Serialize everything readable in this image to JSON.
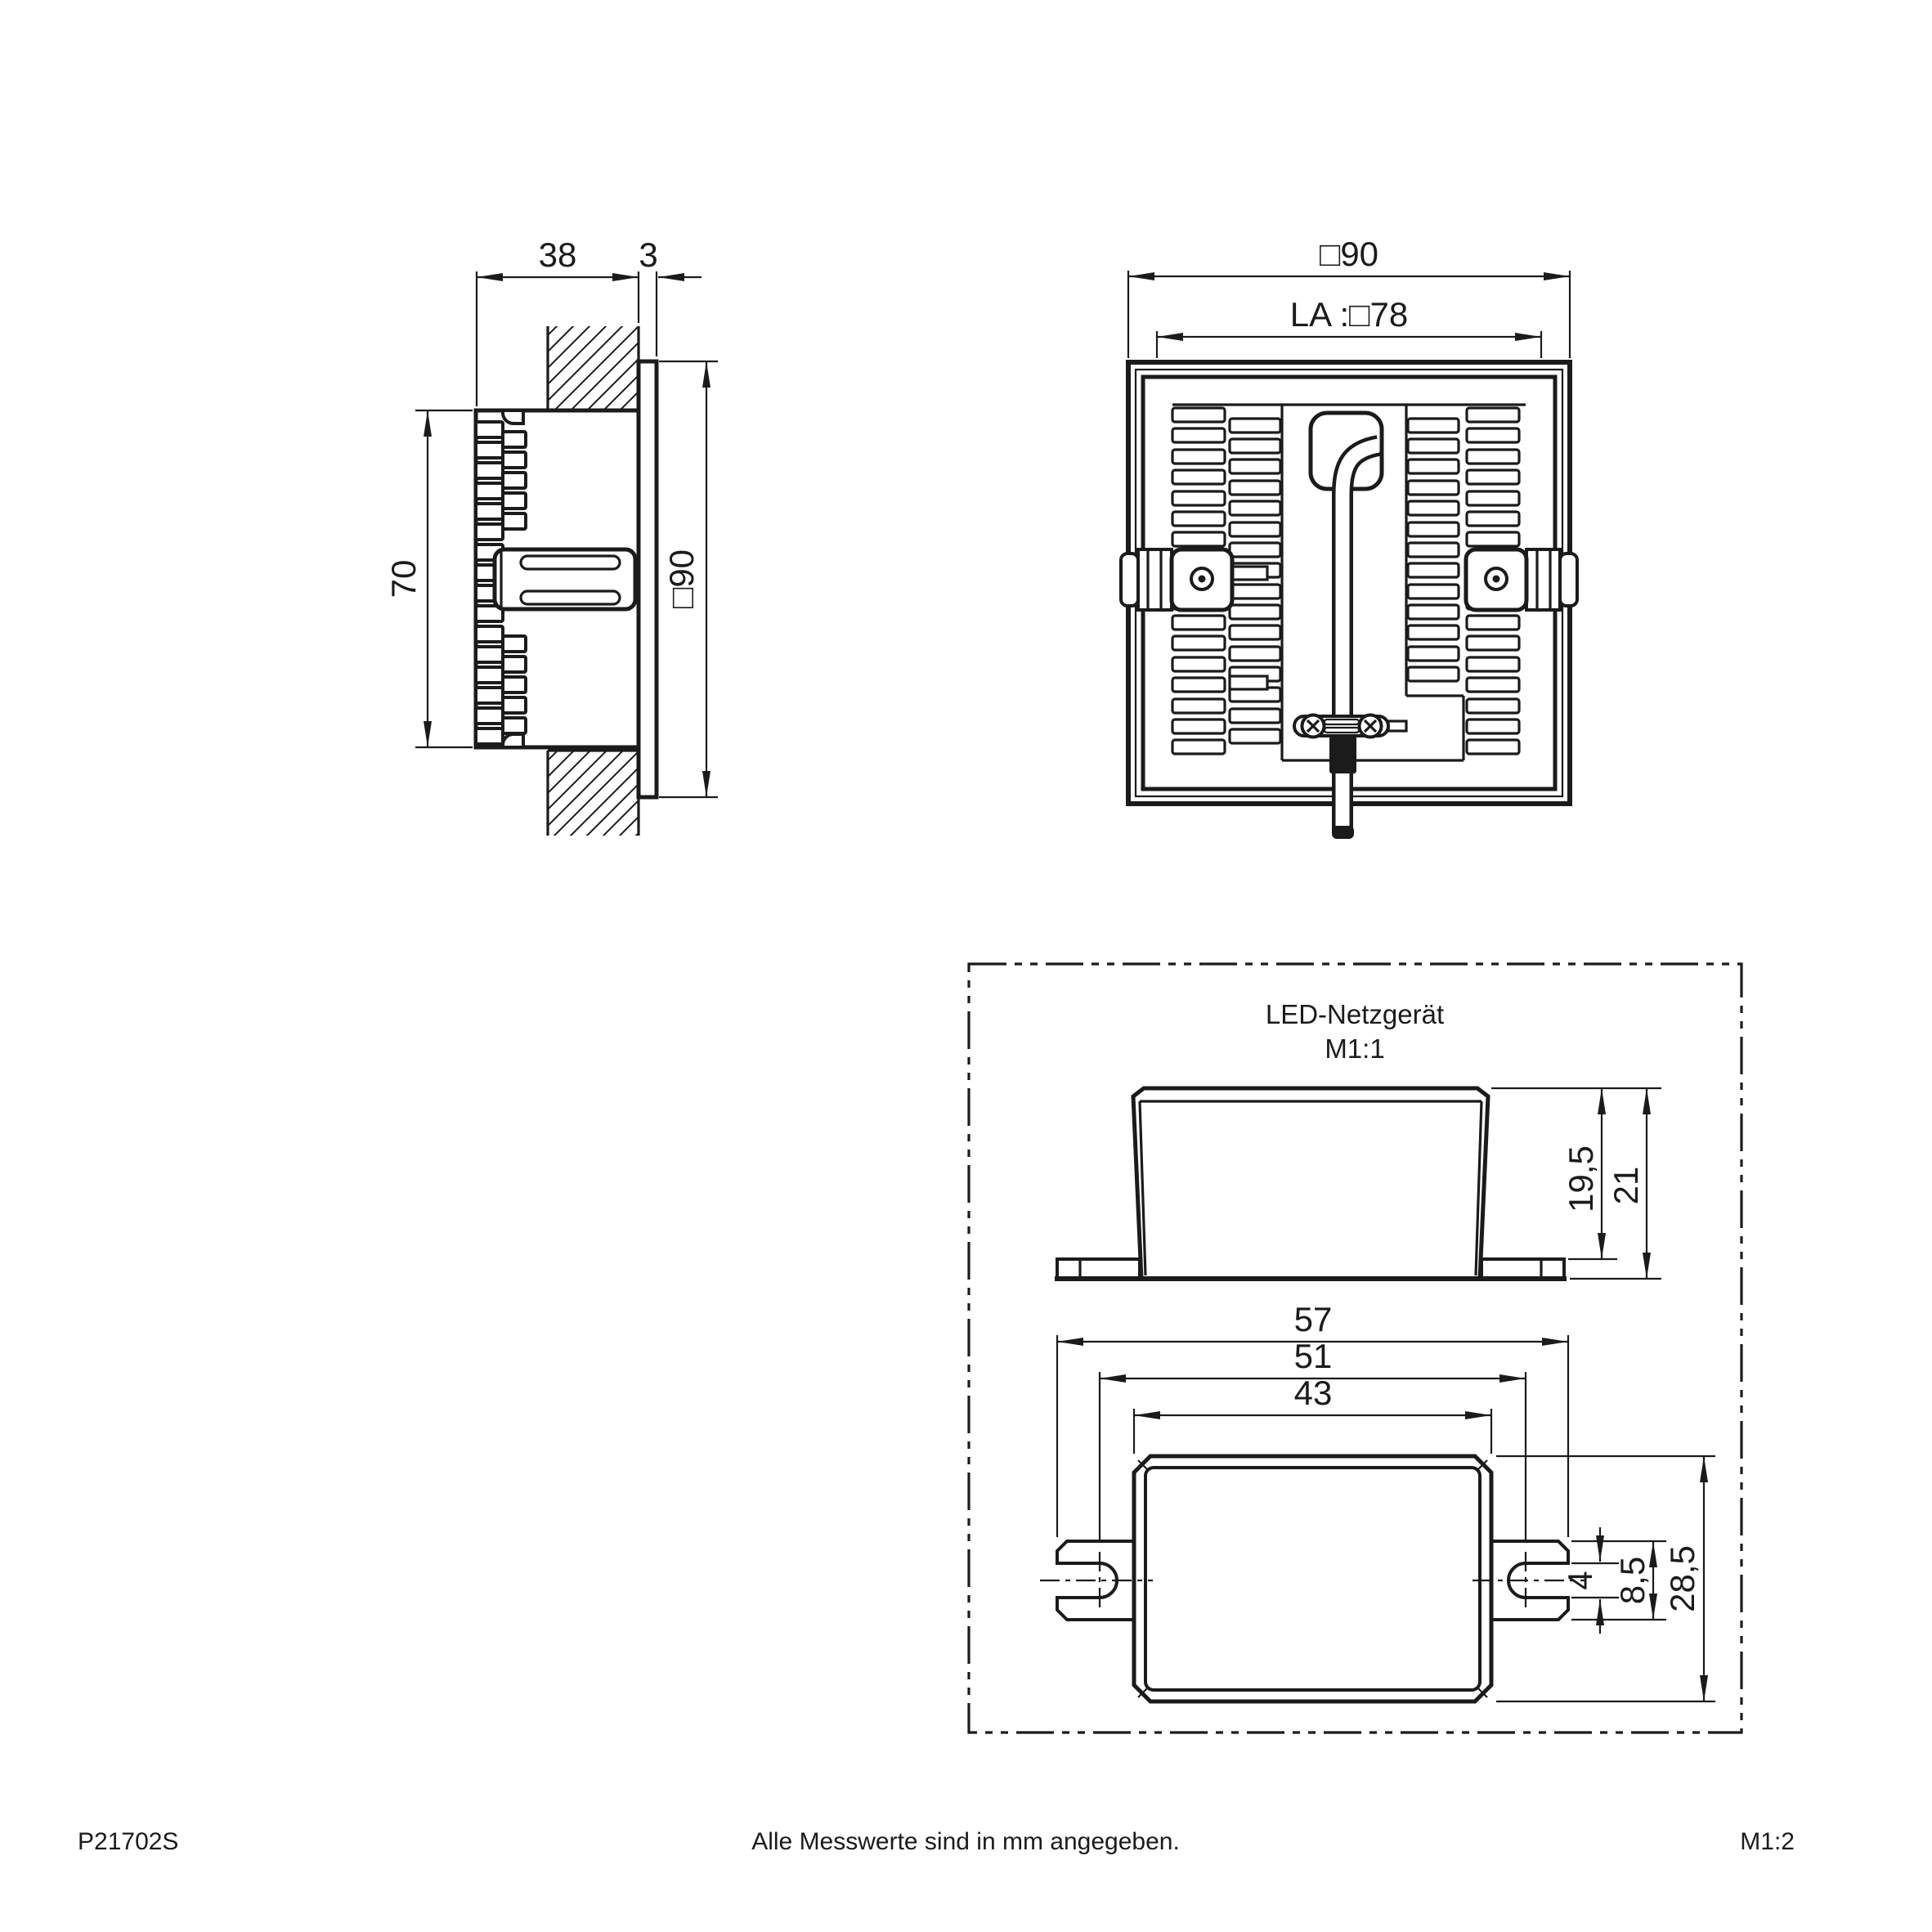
{
  "drawing": {
    "side_view": {
      "depth": "38",
      "bezel": "3",
      "height": "70",
      "face": "□90"
    },
    "rear_view": {
      "outer": "□90",
      "cutout": "LA :□78"
    },
    "psu": {
      "title": "LED-Netzgerät",
      "scale": "M1:1",
      "body_height": "19,5",
      "total_height": "21",
      "total_width": "57",
      "slot_distance": "51",
      "body_width": "43",
      "slot_width": "4",
      "tab_height": "8,5",
      "body_depth": "28,5"
    },
    "footer": {
      "part_number": "P21702S",
      "note": "Alle Messwerte sind in mm angegeben.",
      "page_scale": "M1:2"
    }
  }
}
